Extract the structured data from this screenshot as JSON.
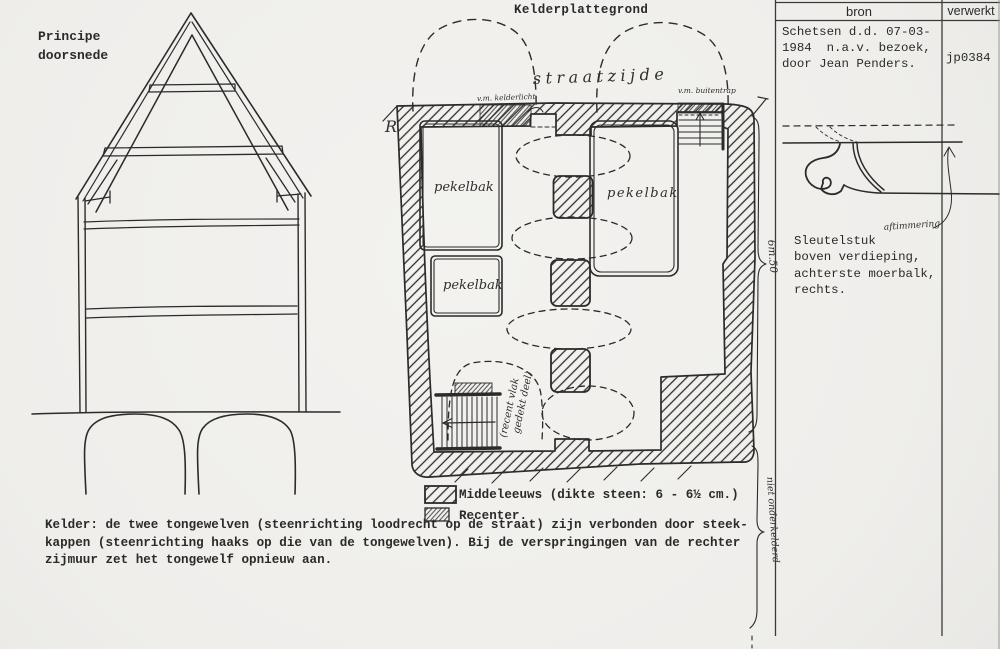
{
  "colors": {
    "paper": "#f0efec",
    "ink": "#2b2b2b"
  },
  "cross_section": {
    "label": "Principe\ndoorsnede"
  },
  "plan": {
    "title": "Kelderplattegrond",
    "street_side": "straatzijde",
    "corner_letter": "R",
    "former_cellar_light": "v.m. kelderlicht",
    "former_outside_stair": "v.m. buitentrap",
    "brine_tub_1": "pekelbak",
    "brine_tub_2": "pekelbak",
    "brine_tub_3": "pekelbak",
    "recent_covered_line1": "(recent vlak",
    "recent_covered_line2": "gedekt deel)",
    "dimension": "6m.50",
    "not_cellared": "niet onderkelderd"
  },
  "legend": {
    "medieval": "Middeleeuws (dikte steen: 6 - 6½ cm.)",
    "recent": "Recenter."
  },
  "caption": "Kelder: de twee tongewelven (steenrichting loodrecht op de straat) zijn verbonden door steek-\nkappen (steenrichting haaks op die van de tongewelven). Bij de verspringingen van de rechter\nzijmuur zet het tongewelf opnieuw aan.",
  "panel": {
    "col_source": "bron",
    "col_processed": "verwerkt",
    "source_text": "Schetsen d.d. 07-03-\n1984  n.a.v. bezoek,\ndoor Jean Penders.",
    "code": "jp0384",
    "sketch_note": "aftimmering",
    "sketch_caption": "Sleutelstuk\nboven verdieping,\nachterste moerbalk,\nrechts."
  }
}
